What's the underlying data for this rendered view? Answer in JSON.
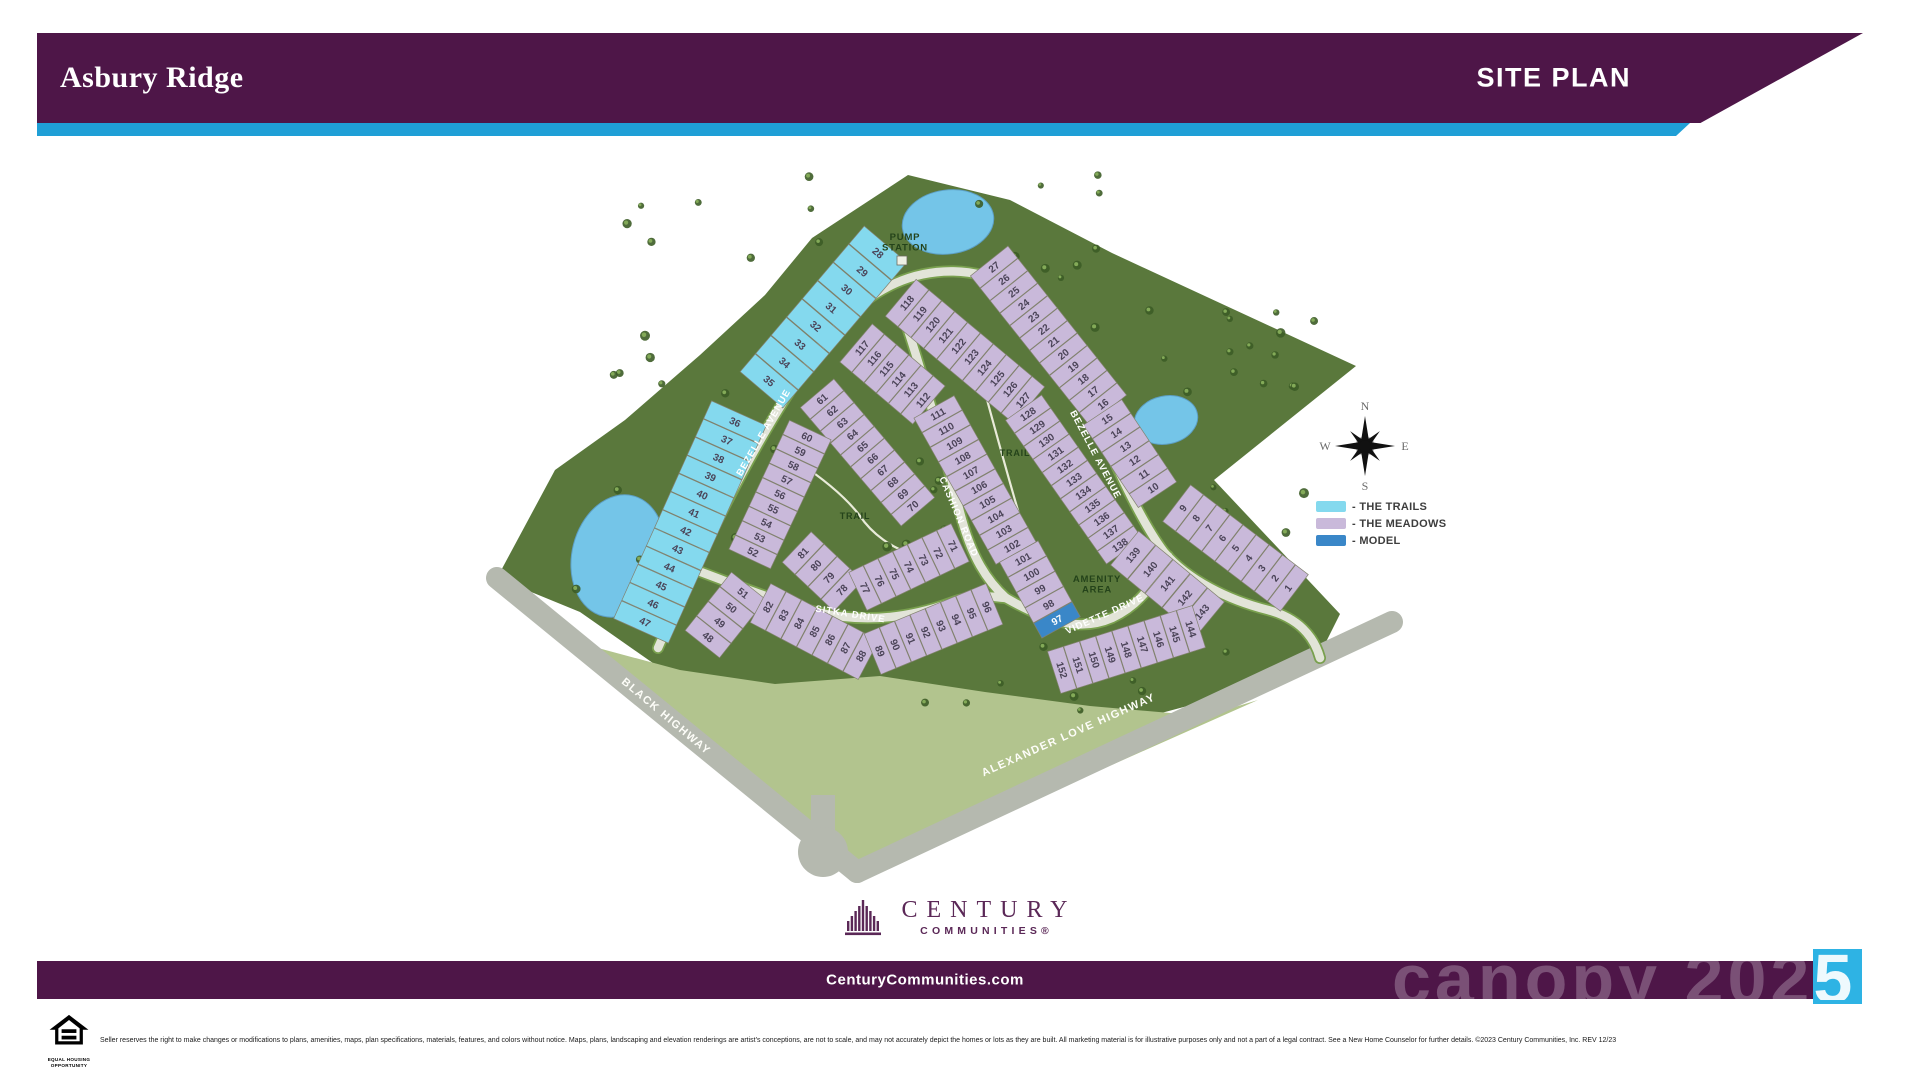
{
  "header": {
    "community_name": "Asbury Ridge",
    "page_label": "SITE PLAN"
  },
  "colors": {
    "brand_purple": "#4e1648",
    "accent_blue": "#1f9fd6",
    "trails": "#84d9ee",
    "meadows": "#c9b9da",
    "model": "#3a87c8",
    "forest": "#5a783c",
    "field": "#b2c48e",
    "highway": "#b5b9af",
    "road": "#e2e4d8",
    "road_edge": "#79a04e",
    "pond": "#74c5e8",
    "watermark_square": "#2eb3e4"
  },
  "legend": {
    "items": [
      {
        "key": "trails",
        "label": "- THE TRAILS"
      },
      {
        "key": "meadows",
        "label": "- THE MEADOWS"
      },
      {
        "key": "model",
        "label": "- MODEL"
      }
    ]
  },
  "compass": {
    "north": "N",
    "east": "E",
    "south": "S",
    "west": "W"
  },
  "map": {
    "labels": [
      {
        "text": "PUMP\nSTATION",
        "x": 905,
        "y": 240,
        "size": 9.5
      },
      {
        "text": "TRAIL",
        "x": 855,
        "y": 519,
        "size": 9
      },
      {
        "text": "TRAIL",
        "x": 1015,
        "y": 456,
        "size": 9
      },
      {
        "text": "AMENITY\nAREA",
        "x": 1097,
        "y": 582,
        "size": 9.5
      }
    ],
    "streets": [
      {
        "name": "BEZELLE AVENUE",
        "x": 766,
        "y": 434,
        "rot": -60,
        "kind": "street"
      },
      {
        "name": "BEZELLE AVENUE",
        "x": 1093,
        "y": 456,
        "rot": 62,
        "kind": "street"
      },
      {
        "name": "CASHION ROAD",
        "x": 956,
        "y": 518,
        "rot": 67,
        "kind": "street"
      },
      {
        "name": "SITKA DRIVE",
        "x": 850,
        "y": 617,
        "rot": 9,
        "kind": "street"
      },
      {
        "name": "VIDETTE DRIVE",
        "x": 1106,
        "y": 617,
        "rot": -24,
        "kind": "street"
      },
      {
        "name": "BLACK HIGHWAY",
        "x": 664,
        "y": 719,
        "rot": 40,
        "kind": "highway"
      },
      {
        "name": "ALEXANDER LOVE HIGHWAY",
        "x": 1070,
        "y": 738,
        "rot": -24,
        "kind": "highway"
      }
    ],
    "lot_strips": [
      {
        "from": [
          878,
          253
        ],
        "to": [
          769,
          381
        ],
        "count": 8,
        "start": 28,
        "step": 1,
        "depth": 56,
        "cat": "trails"
      },
      {
        "from": [
          735,
          422
        ],
        "to": [
          645,
          622
        ],
        "count": 12,
        "start": 36,
        "step": 1,
        "depth": 60,
        "cat": "trails"
      },
      {
        "from": [
          907,
          303
        ],
        "to": [
          1023,
          400
        ],
        "count": 10,
        "start": 118,
        "step": 1,
        "depth": 48,
        "cat": "meadows"
      },
      {
        "from": [
          862,
          348
        ],
        "to": [
          923,
          400
        ],
        "count": 6,
        "start": 117,
        "step": -1,
        "depth": 50,
        "cat": "meadows"
      },
      {
        "from": [
          994,
          267
        ],
        "to": [
          1103,
          404
        ],
        "count": 12,
        "start": 27,
        "step": -1,
        "depth": 48,
        "cat": "meadows"
      },
      {
        "from": [
          1107,
          419
        ],
        "to": [
          1153,
          488
        ],
        "count": 6,
        "start": 15,
        "step": -1,
        "depth": 46,
        "cat": "meadows"
      },
      {
        "from": [
          1183,
          508
        ],
        "to": [
          1288,
          588
        ],
        "count": 9,
        "start": 9,
        "step": -1,
        "depth": 46,
        "cat": "meadows"
      },
      {
        "from": [
          938,
          414
        ],
        "to": [
          1012,
          546
        ],
        "count": 10,
        "start": 111,
        "step": -1,
        "depth": 46,
        "cat": "meadows"
      },
      {
        "from": [
          1023,
          559
        ],
        "to": [
          1057,
          620
        ],
        "count": 5,
        "start": 101,
        "step": -1,
        "depth": 44,
        "cat": "meadows",
        "model_numbers": [
          97
        ]
      },
      {
        "from": [
          1028,
          414
        ],
        "to": [
          1120,
          545
        ],
        "count": 11,
        "start": 128,
        "step": 1,
        "depth": 44,
        "cat": "meadows"
      },
      {
        "from": [
          1133,
          555
        ],
        "to": [
          1202,
          612
        ],
        "count": 5,
        "start": 139,
        "step": 1,
        "depth": 44,
        "cat": "meadows"
      },
      {
        "from": [
          1062,
          670
        ],
        "to": [
          1191,
          629
        ],
        "count": 9,
        "start": 152,
        "step": -1,
        "depth": 44,
        "cat": "meadows"
      },
      {
        "from": [
          822,
          399
        ],
        "to": [
          913,
          506
        ],
        "count": 10,
        "start": 61,
        "step": 1,
        "depth": 44,
        "cat": "meadows"
      },
      {
        "from": [
          807,
          437
        ],
        "to": [
          753,
          552
        ],
        "count": 9,
        "start": 60,
        "step": -1,
        "depth": 46,
        "cat": "meadows"
      },
      {
        "from": [
          743,
          593
        ],
        "to": [
          708,
          637
        ],
        "count": 4,
        "start": 51,
        "step": -1,
        "depth": 44,
        "cat": "meadows"
      },
      {
        "from": [
          768,
          607
        ],
        "to": [
          861,
          656
        ],
        "count": 7,
        "start": 82,
        "step": 1,
        "depth": 44,
        "cat": "meadows"
      },
      {
        "from": [
          880,
          651
        ],
        "to": [
          987,
          607
        ],
        "count": 8,
        "start": 89,
        "step": 1,
        "depth": 44,
        "cat": "meadows"
      },
      {
        "from": [
          803,
          553
        ],
        "to": [
          842,
          590
        ],
        "count": 4,
        "start": 81,
        "step": -1,
        "depth": 42,
        "cat": "meadows"
      },
      {
        "from": [
          865,
          588
        ],
        "to": [
          953,
          546
        ],
        "count": 7,
        "start": 77,
        "step": -1,
        "depth": 42,
        "cat": "meadows"
      }
    ]
  },
  "footer": {
    "logo_line1": "CENTURY",
    "logo_line2": "COMMUNITIES®",
    "website": "CenturyCommunities.com",
    "watermark_muted": "canopy 202",
    "watermark_bright": "5",
    "equal_housing_line1": "EQUAL HOUSING",
    "equal_housing_line2": "OPPORTUNITY",
    "disclaimer": "Seller reserves the right to make changes or modifications to plans, amenities, maps, plan specifications, materials, features, and colors without notice. Maps, plans, landscaping and elevation renderings are artist's conceptions, are not to scale, and may not accurately depict the homes or lots as they are built. All marketing material is for illustrative purposes only and not a part of a legal contract. See a New Home Counselor for further details. ©2023 Century Communities, Inc. REV 12/23"
  }
}
